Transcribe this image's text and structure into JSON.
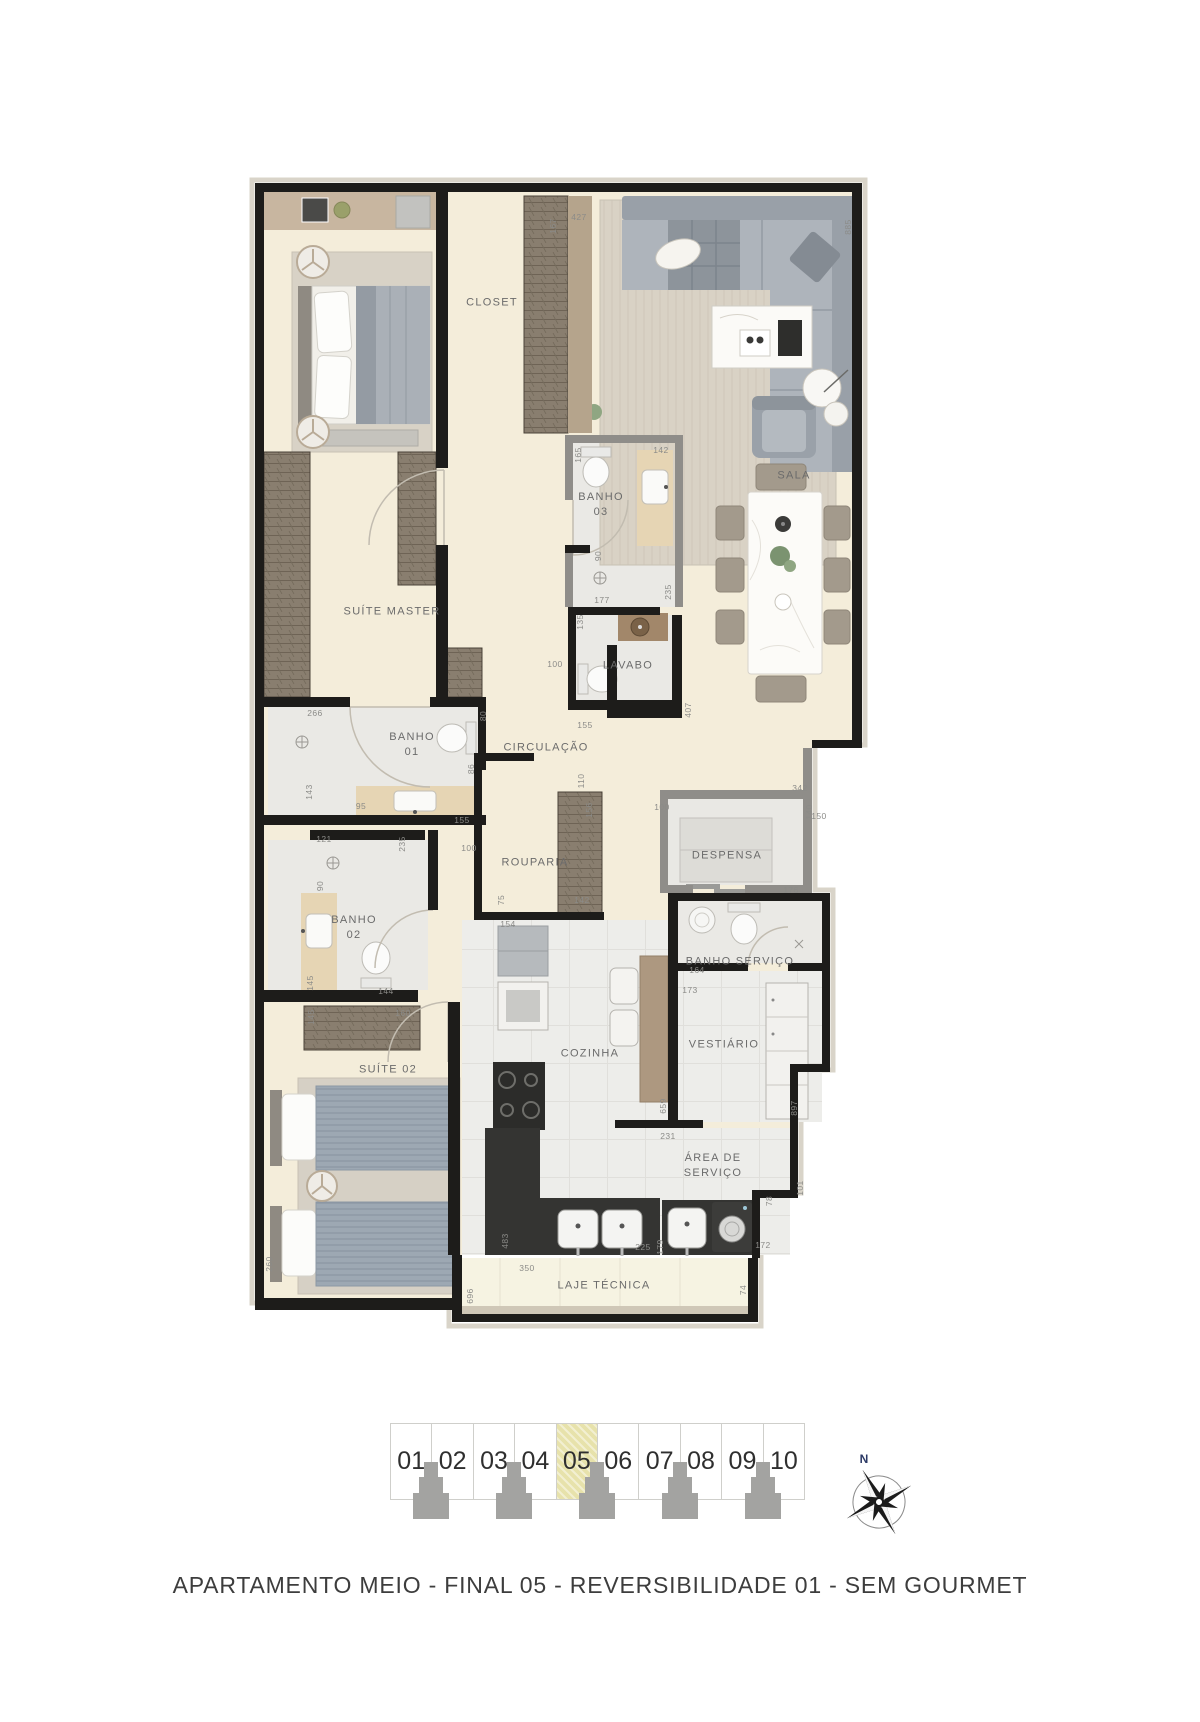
{
  "caption": "APARTAMENTO MEIO - FINAL 05 - REVERSIBILIDADE 01 - SEM GOURMET",
  "compass": {
    "north_label": "N"
  },
  "colors": {
    "highlight_cell": "#e7e2ab",
    "wall": "#1d1c1a",
    "wall_light": "#8f8d89",
    "floor_beige": "#f4edda",
    "floor_bath": "#eae9e5",
    "dim_text": "#8b8b88",
    "label_text": "#6b6b6b",
    "north_text": "#2c3a66"
  },
  "floorplan": {
    "rooms": [
      {
        "id": "closet",
        "lines": [
          "CLOSET"
        ],
        "x": 492,
        "y": 303
      },
      {
        "id": "sala",
        "lines": [
          "SALA"
        ],
        "x": 794,
        "y": 476
      },
      {
        "id": "banho-03",
        "lines": [
          "BANHO",
          "03"
        ],
        "x": 601,
        "y": 505
      },
      {
        "id": "suite-master",
        "lines": [
          "SUÍTE MASTER"
        ],
        "x": 392,
        "y": 612
      },
      {
        "id": "lavabo",
        "lines": [
          "LAVABO"
        ],
        "x": 628,
        "y": 666
      },
      {
        "id": "banho-01",
        "lines": [
          "BANHO",
          "01"
        ],
        "x": 412,
        "y": 745
      },
      {
        "id": "circulacao",
        "lines": [
          "CIRCULAÇÃO"
        ],
        "x": 546,
        "y": 748
      },
      {
        "id": "rouparia",
        "lines": [
          "ROUPARIA"
        ],
        "x": 535,
        "y": 863
      },
      {
        "id": "despensa",
        "lines": [
          "DESPENSA"
        ],
        "x": 727,
        "y": 856
      },
      {
        "id": "banho-02",
        "lines": [
          "BANHO",
          "02"
        ],
        "x": 354,
        "y": 928
      },
      {
        "id": "banho-servico",
        "lines": [
          "BANHO SERVIÇO"
        ],
        "x": 740,
        "y": 962
      },
      {
        "id": "vestiario",
        "lines": [
          "VESTIÁRIO"
        ],
        "x": 724,
        "y": 1045
      },
      {
        "id": "suite-02",
        "lines": [
          "SUÍTE 02"
        ],
        "x": 388,
        "y": 1070
      },
      {
        "id": "cozinha",
        "lines": [
          "COZINHA"
        ],
        "x": 590,
        "y": 1054
      },
      {
        "id": "area-servico",
        "lines": [
          "ÁREA DE",
          "SERVIÇO"
        ],
        "x": 713,
        "y": 1166
      },
      {
        "id": "laje-tecnica",
        "lines": [
          "LAJE TÉCNICA"
        ],
        "x": 604,
        "y": 1286
      }
    ],
    "dimensions": [
      {
        "v": "167",
        "x": 553,
        "y": 226,
        "rot": true
      },
      {
        "v": "427",
        "x": 579,
        "y": 217,
        "rot": false
      },
      {
        "v": "885",
        "x": 848,
        "y": 227,
        "rot": true
      },
      {
        "v": "165",
        "x": 578,
        "y": 455,
        "rot": true
      },
      {
        "v": "142",
        "x": 661,
        "y": 450,
        "rot": false
      },
      {
        "v": "90",
        "x": 598,
        "y": 556,
        "rot": true
      },
      {
        "v": "177",
        "x": 602,
        "y": 600,
        "rot": false
      },
      {
        "v": "235",
        "x": 668,
        "y": 592,
        "rot": true
      },
      {
        "v": "135",
        "x": 580,
        "y": 622,
        "rot": true
      },
      {
        "v": "100",
        "x": 555,
        "y": 664,
        "rot": false
      },
      {
        "v": "155",
        "x": 585,
        "y": 725,
        "rot": false
      },
      {
        "v": "407",
        "x": 688,
        "y": 710,
        "rot": true
      },
      {
        "v": "266",
        "x": 315,
        "y": 713,
        "rot": false
      },
      {
        "v": "80",
        "x": 483,
        "y": 716,
        "rot": true
      },
      {
        "v": "86",
        "x": 471,
        "y": 769,
        "rot": true
      },
      {
        "v": "143",
        "x": 309,
        "y": 792,
        "rot": true
      },
      {
        "v": "95",
        "x": 361,
        "y": 806,
        "rot": false
      },
      {
        "v": "155",
        "x": 462,
        "y": 820,
        "rot": false
      },
      {
        "v": "100",
        "x": 469,
        "y": 848,
        "rot": false
      },
      {
        "v": "110",
        "x": 581,
        "y": 781,
        "rot": true
      },
      {
        "v": "156",
        "x": 589,
        "y": 810,
        "rot": true
      },
      {
        "v": "142",
        "x": 582,
        "y": 900,
        "rot": false
      },
      {
        "v": "75",
        "x": 501,
        "y": 900,
        "rot": true
      },
      {
        "v": "154",
        "x": 508,
        "y": 924,
        "rot": false
      },
      {
        "v": "121",
        "x": 324,
        "y": 839,
        "rot": false
      },
      {
        "v": "235",
        "x": 402,
        "y": 844,
        "rot": true
      },
      {
        "v": "90",
        "x": 320,
        "y": 886,
        "rot": true
      },
      {
        "v": "145",
        "x": 310,
        "y": 983,
        "rot": true
      },
      {
        "v": "144",
        "x": 386,
        "y": 991,
        "rot": false
      },
      {
        "v": "145",
        "x": 311,
        "y": 1017,
        "rot": true
      },
      {
        "v": "160",
        "x": 403,
        "y": 1013,
        "rot": false
      },
      {
        "v": "342",
        "x": 800,
        "y": 788,
        "rot": false
      },
      {
        "v": "140",
        "x": 809,
        "y": 812,
        "rot": true
      },
      {
        "v": "150",
        "x": 819,
        "y": 816,
        "rot": false
      },
      {
        "v": "176",
        "x": 791,
        "y": 890,
        "rot": false
      },
      {
        "v": "100",
        "x": 662,
        "y": 807,
        "rot": false
      },
      {
        "v": "164",
        "x": 697,
        "y": 970,
        "rot": false
      },
      {
        "v": "173",
        "x": 690,
        "y": 990,
        "rot": false
      },
      {
        "v": "659",
        "x": 663,
        "y": 1106,
        "rot": true
      },
      {
        "v": "897",
        "x": 794,
        "y": 1108,
        "rot": true
      },
      {
        "v": "231",
        "x": 668,
        "y": 1136,
        "rot": false
      },
      {
        "v": "101",
        "x": 800,
        "y": 1188,
        "rot": true
      },
      {
        "v": "78",
        "x": 769,
        "y": 1201,
        "rot": true
      },
      {
        "v": "483",
        "x": 505,
        "y": 1241,
        "rot": true
      },
      {
        "v": "225",
        "x": 643,
        "y": 1247,
        "rot": false
      },
      {
        "v": "179",
        "x": 660,
        "y": 1247,
        "rot": true
      },
      {
        "v": "172",
        "x": 763,
        "y": 1245,
        "rot": false
      },
      {
        "v": "350",
        "x": 527,
        "y": 1268,
        "rot": false
      },
      {
        "v": "696",
        "x": 470,
        "y": 1296,
        "rot": true
      },
      {
        "v": "74",
        "x": 743,
        "y": 1290,
        "rot": true
      },
      {
        "v": "260",
        "x": 269,
        "y": 1264,
        "rot": true
      }
    ]
  },
  "unit_strip": {
    "units": [
      {
        "label": "01",
        "highlighted": false
      },
      {
        "label": "02",
        "highlighted": false
      },
      {
        "label": "03",
        "highlighted": false
      },
      {
        "label": "04",
        "highlighted": false
      },
      {
        "label": "05",
        "highlighted": true
      },
      {
        "label": "06",
        "highlighted": false
      },
      {
        "label": "07",
        "highlighted": false
      },
      {
        "label": "08",
        "highlighted": false
      },
      {
        "label": "09",
        "highlighted": false
      },
      {
        "label": "10",
        "highlighted": false
      }
    ]
  }
}
